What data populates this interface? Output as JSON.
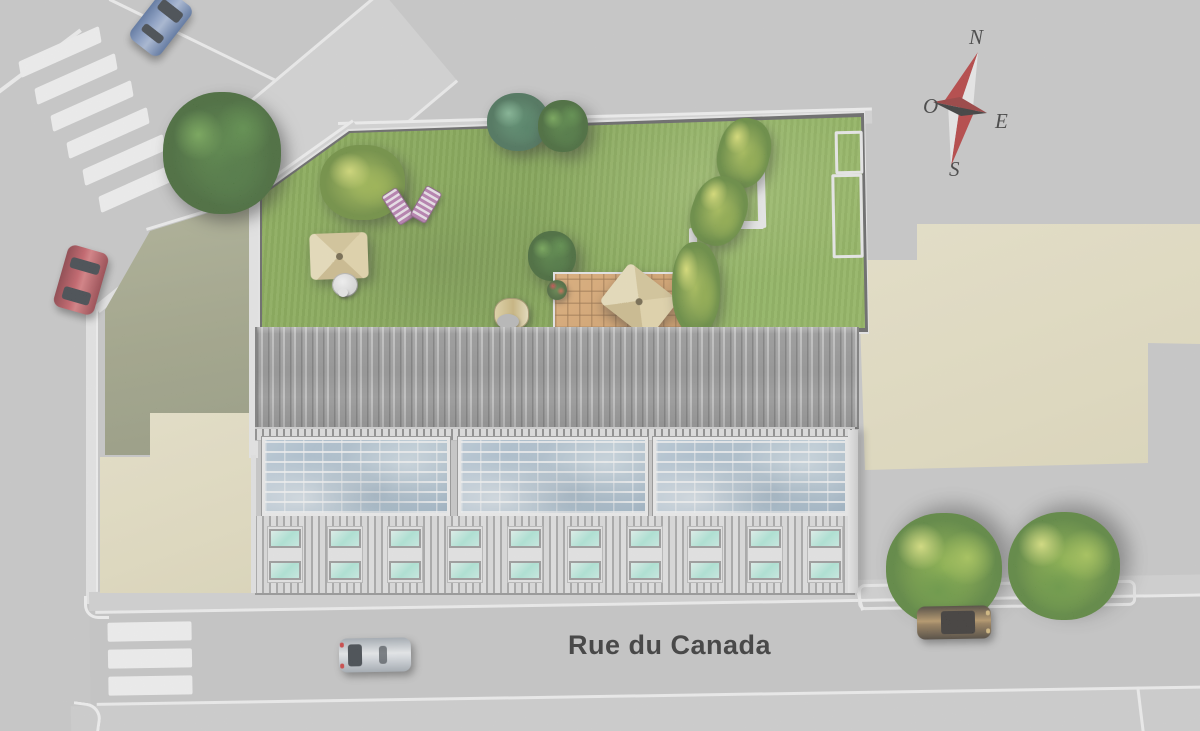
{
  "plan": {
    "type": "rooftop-site-plan",
    "street": {
      "name": "Rue du Canada"
    },
    "compass": {
      "north": "N",
      "east": "E",
      "south": "S",
      "west": "O"
    },
    "palette": {
      "pavement": "#c8c8c8",
      "road_marking": "#fafafa",
      "lawn_green": "#7aa637",
      "olive_lot": "#9a9e7c",
      "sand_lot": "#ece5c3",
      "metal_roof": "#8f8f8f",
      "solar_glass": "#a9c1d2",
      "facade": "#e3e3e3",
      "window_cyan": "#aef0de",
      "deck_wood": "#d79a55",
      "compass_red": "#b02020",
      "lounger_pink": "#b06aa6",
      "parasol_beige": "#e0cf97"
    },
    "counts": {
      "solar_panels": 3,
      "window_pairs": 10,
      "crosswalk_stripes_diagonal": 6,
      "crosswalk_stripes_bottom": 3,
      "cars": 4,
      "street_trees": 5
    }
  }
}
